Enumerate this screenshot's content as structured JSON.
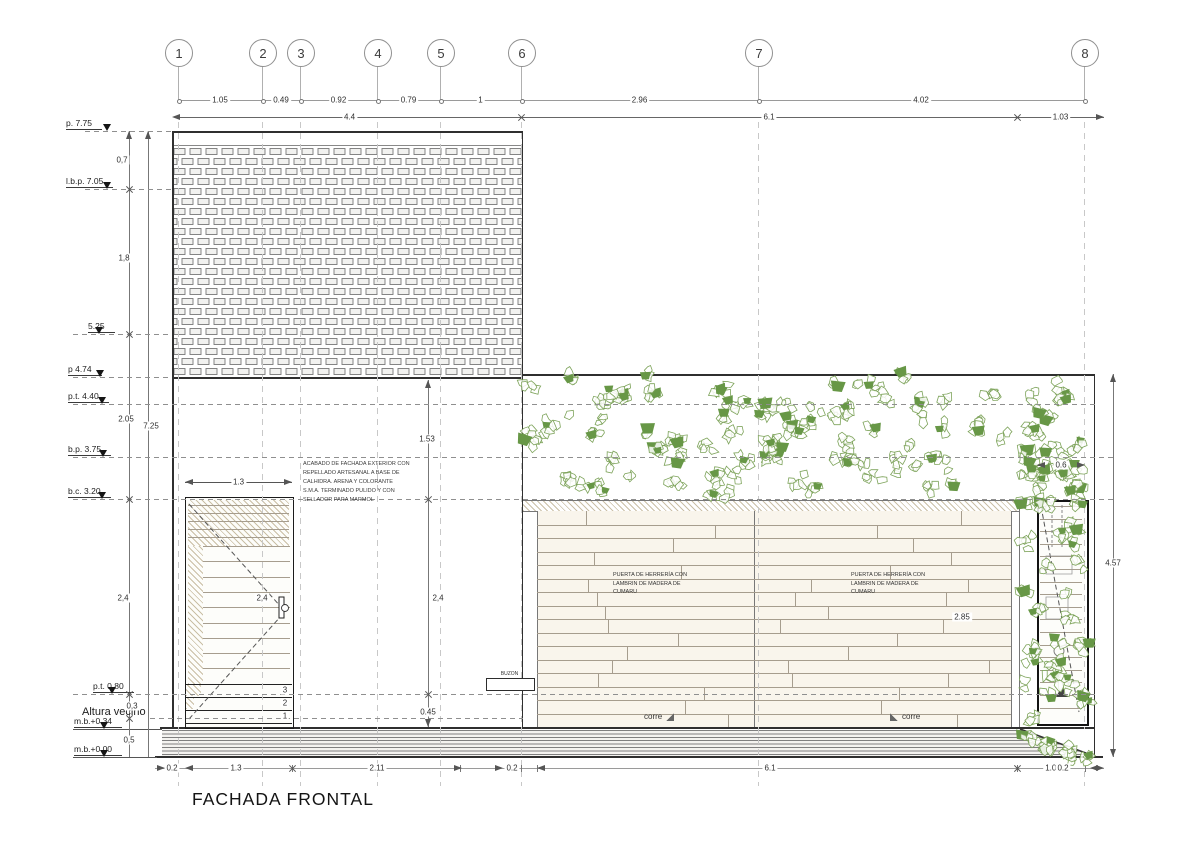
{
  "title": "FACHADA FRONTAL",
  "grid_bubbles": [
    {
      "label": "1",
      "x": 178
    },
    {
      "label": "2",
      "x": 262
    },
    {
      "label": "3",
      "x": 300
    },
    {
      "label": "4",
      "x": 377
    },
    {
      "label": "5",
      "x": 440
    },
    {
      "label": "6",
      "x": 521
    },
    {
      "label": "7",
      "x": 758
    },
    {
      "label": "8",
      "x": 1084
    }
  ],
  "dims_row1": {
    "y": 100,
    "segments": [
      {
        "label": "1.05",
        "x1": 178,
        "x2": 262
      },
      {
        "label": "0.49",
        "x1": 262,
        "x2": 300
      },
      {
        "label": "0.92",
        "x1": 300,
        "x2": 377
      },
      {
        "label": "0.79",
        "x1": 377,
        "x2": 440
      },
      {
        "label": "1",
        "x1": 440,
        "x2": 521
      },
      {
        "label": "2.96",
        "x1": 521,
        "x2": 758
      },
      {
        "label": "4.02",
        "x1": 758,
        "x2": 1084
      }
    ]
  },
  "dims_row2": {
    "y": 117,
    "segments": [
      {
        "label": "4.4",
        "x1": 178,
        "x2": 521,
        "arrowL": true,
        "xtickR": true
      },
      {
        "label": "6.1",
        "x1": 521,
        "x2": 1017,
        "xtickR": true
      },
      {
        "label": "1.03",
        "x1": 1017,
        "x2": 1104,
        "arrowR": true
      }
    ]
  },
  "levels": [
    {
      "label": "p. 7.75",
      "y": 131,
      "label_x": 66,
      "tri_x": 107,
      "x1": 85,
      "x2": 172,
      "style": "dash"
    },
    {
      "label": "l.b.p. 7.05",
      "y": 189,
      "label_x": 66,
      "tri_x": 107,
      "x1": 85,
      "x2": 172,
      "style": "dash"
    },
    {
      "label": "5.25",
      "y": 334,
      "label_x": 88,
      "tri_x": 99,
      "x1": 73,
      "x2": 172,
      "style": "dash"
    },
    {
      "label": "p 4.74",
      "y": 377,
      "label_x": 68,
      "tri_x": 100,
      "x1": 73,
      "x2": 172,
      "style": "dash"
    },
    {
      "label": "p.t. 4.40",
      "y": 404,
      "label_x": 68,
      "tri_x": 102,
      "x1": 73,
      "x2": 1095,
      "style": "dash"
    },
    {
      "label": "b.p. 3.75",
      "y": 457,
      "label_x": 68,
      "tri_x": 103,
      "x1": 73,
      "x2": 1113,
      "style": "dash"
    },
    {
      "label": "b.c. 3.20",
      "y": 499,
      "label_x": 68,
      "tri_x": 102,
      "x1": 73,
      "x2": 1113,
      "style": "dash"
    },
    {
      "label": "p.t. 0.80",
      "y": 694,
      "label_x": 93,
      "tri_x": 112,
      "x1": 73,
      "x2": 1095,
      "style": "dash"
    },
    {
      "label": "m.b.+0.34",
      "y": 729,
      "label_x": 74,
      "tri_x": 104,
      "x1": 73,
      "x2": 162,
      "style": "solid"
    },
    {
      "label": "m.b.+0.00",
      "y": 757,
      "label_x": 74,
      "tri_x": 104,
      "x1": 73,
      "x2": 157,
      "style": "solid"
    }
  ],
  "altura_vecino": {
    "label": "Altura vecino",
    "x": 82,
    "y": 706,
    "x1": 150,
    "x2": 523,
    "line_y": 718
  },
  "vdim_lines": [
    {
      "x": 129,
      "y1": 131,
      "y2": 757,
      "aTop": true
    },
    {
      "x": 148,
      "y1": 131,
      "y2": 757,
      "aTop": true
    },
    {
      "x": 428,
      "y1": 380,
      "y2": 727,
      "aTop": true,
      "aBot": true
    },
    {
      "x": 1113,
      "y1": 374,
      "y2": 757,
      "aTop": true,
      "aBot": true
    }
  ],
  "vdim_ticks": [
    {
      "x": 129,
      "y": 189
    },
    {
      "x": 129,
      "y": 334
    },
    {
      "x": 129,
      "y": 499
    },
    {
      "x": 129,
      "y": 694
    },
    {
      "x": 129,
      "y": 718
    },
    {
      "x": 428,
      "y": 499
    },
    {
      "x": 428,
      "y": 694
    }
  ],
  "vdim_labels": [
    {
      "label": "0,7",
      "x": 122,
      "y": 160
    },
    {
      "label": "1,8",
      "x": 124,
      "y": 258
    },
    {
      "label": "2.05",
      "x": 126,
      "y": 419
    },
    {
      "label": "7.25",
      "x": 151,
      "y": 426
    },
    {
      "label": "2,4",
      "x": 123,
      "y": 598
    },
    {
      "label": "0,3",
      "x": 132,
      "y": 706
    },
    {
      "label": "0,5",
      "x": 129,
      "y": 740
    },
    {
      "label": "1.53",
      "x": 427,
      "y": 439
    },
    {
      "label": "2,4",
      "x": 438,
      "y": 598
    },
    {
      "label": "0.45",
      "x": 428,
      "y": 712
    },
    {
      "label": "4.57",
      "x": 1113,
      "y": 563
    },
    {
      "label": "2,4",
      "x": 262,
      "y": 598
    },
    {
      "label": "2.85",
      "x": 962,
      "y": 617
    }
  ],
  "hdims": [
    {
      "label": "1.3",
      "x1": 185,
      "x2": 292,
      "y": 482
    },
    {
      "label": "0.6",
      "x1": 1037,
      "x2": 1085,
      "y": 465
    }
  ],
  "dims_bottom": {
    "y": 768,
    "x1": 155,
    "x2": 1104,
    "ticks": [
      178,
      292,
      460,
      521,
      537,
      1017,
      1085
    ],
    "xticks": [
      292,
      1017
    ],
    "labels": [
      {
        "label": "0.2",
        "x": 172
      },
      {
        "label": "1.3",
        "x": 236
      },
      {
        "label": "2.11",
        "x": 377
      },
      {
        "label": "0.2",
        "x": 512
      },
      {
        "label": "6.1",
        "x": 770
      },
      {
        "label": "1.03",
        "x": 1053
      },
      {
        "label": "0.2",
        "x": 1063
      }
    ]
  },
  "note": {
    "lines": [
      "ACABADO DE FACHADA EXTERIOR CON",
      "REPELLADO ARTESANAL A BASE DE",
      "CALHIDRA. ARENA Y COLORANTE",
      "S.M.A. TERMINADO PULIDO Y CON",
      "SELLADOR PARA MARMOL"
    ]
  },
  "door_label_1": {
    "lines": [
      "PUERTA DE HERRERÍA CON",
      "LAMBRIN DE MADERA DE",
      "CUMARU"
    ]
  },
  "door_label_2": {
    "lines": [
      "PUERTA DE HERRERÍA CON",
      "LAMBRIN DE MADERA DE",
      "CUMARU"
    ]
  },
  "corre_left": {
    "label": "corre"
  },
  "corre_right": {
    "label": "corre"
  },
  "buzon": {
    "label": "BUZON"
  },
  "step_numbers": [
    {
      "label": "3",
      "y": 690
    },
    {
      "label": "2",
      "y": 703
    },
    {
      "label": "1",
      "y": 716
    }
  ],
  "colors": {
    "leaf_fill": "#679746",
    "leaf_stroke": "#7da35a",
    "hatch": "#b9a87e",
    "line_dark": "#2f2f2f",
    "line_mid": "#6e6e6e",
    "dash": "#8f8f8f",
    "grid_dash": "#c6c6c6",
    "wood_line": "#a69d8e",
    "wood_bg": "#f9f5ec"
  }
}
